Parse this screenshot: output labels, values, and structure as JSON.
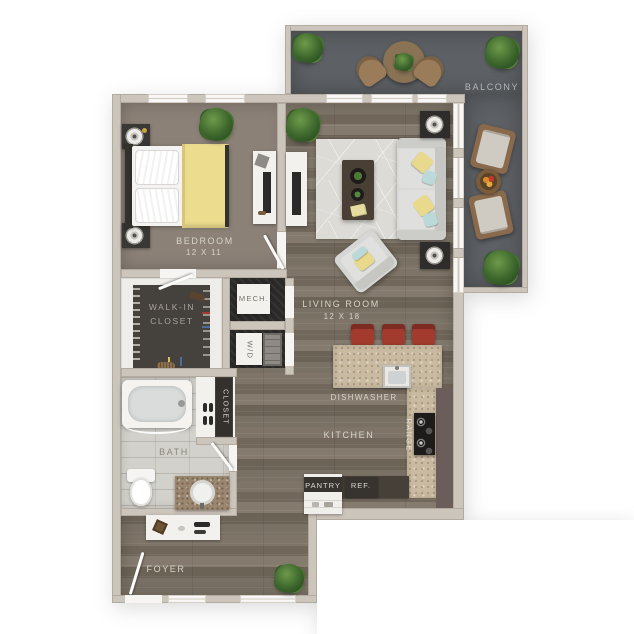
{
  "floor_plan": {
    "rooms": {
      "bedroom": {
        "label": "BEDROOM",
        "dims": "12 X 11"
      },
      "living_room": {
        "label": "LIVING ROOM",
        "dims": "12 X 18"
      },
      "balcony": {
        "label": "BALCONY"
      },
      "walk_in_closet": {
        "line1": "WALK-IN",
        "line2": "CLOSET"
      },
      "mech": {
        "label": "MECH."
      },
      "washer_dryer": {
        "label": "W/D"
      },
      "closet": {
        "label": "CLOSET"
      },
      "bath": {
        "label": "BATH"
      },
      "kitchen": {
        "label": "KITCHEN"
      },
      "foyer": {
        "label": "FOYER"
      }
    },
    "appliances": {
      "dishwasher": {
        "label": "DISHWASHER"
      },
      "range": {
        "label": "RANGE"
      },
      "pantry": {
        "label": "PANTRY"
      },
      "refrigerator": {
        "label": "REF."
      }
    },
    "colors": {
      "wall": "#ccc5bb",
      "bedroom_floor": "#8b8177",
      "wood_floor": "#776d62",
      "balcony_floor": "#5d6064",
      "bath_tile": "#d3d1cb",
      "dark_room_floor": "#2b2927",
      "counter_granite": "#c9baa1",
      "cabinet_dark": "#474039",
      "stool_red": "#a23b2d",
      "accent_yellow": "#e9d98c",
      "accent_blue": "#bcd9da",
      "plant_green": "#3c662c"
    }
  }
}
